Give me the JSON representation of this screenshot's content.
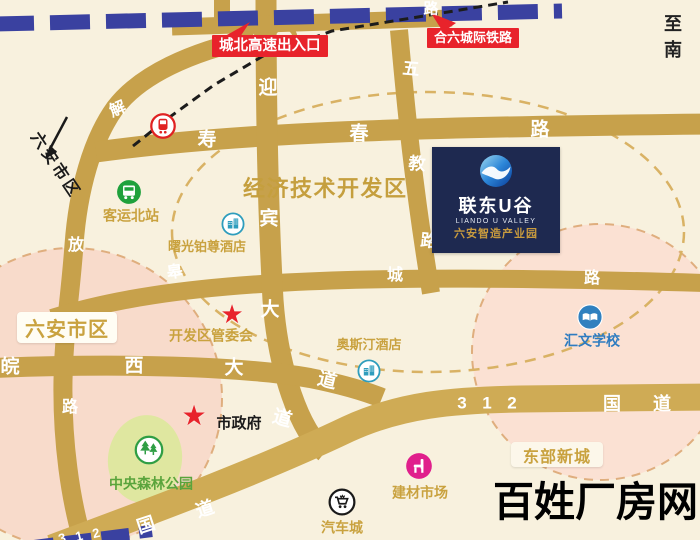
{
  "page": {
    "watermark": "百姓厂房网"
  },
  "map": {
    "zone_title": "经济技术开发区",
    "corner_note": "至南",
    "callouts": [
      {
        "name": "highway-exit-callout",
        "label": "城北高速出入口"
      },
      {
        "name": "intercity-railway-callout",
        "label": "合六城际铁路"
      }
    ],
    "landmark_card": {
      "name_cn": "联东U谷",
      "name_en": "LIANDO U VALLEY",
      "subtitle": "六安智造产业园",
      "logo_icon": "liando-swirl-icon"
    },
    "district_boxes": [
      {
        "name": "luan-downtown-box",
        "label": "六安市区"
      },
      {
        "name": "east-new-town-box",
        "label": "东部新城"
      }
    ],
    "direction_label": {
      "label": "六安市区"
    },
    "roads": [
      {
        "name": "jiefang-road",
        "label": "解放路",
        "chars": [
          {
            "t": "解",
            "x": 118,
            "y": 110,
            "s": 16,
            "r": -22
          },
          {
            "t": "放",
            "x": 76,
            "y": 246,
            "s": 16,
            "r": 0
          },
          {
            "t": "路",
            "x": 70,
            "y": 408,
            "s": 16,
            "r": 0
          }
        ]
      },
      {
        "name": "shouchun-road",
        "label": "寿春路",
        "chars": [
          {
            "t": "寿",
            "x": 207,
            "y": 140,
            "s": 19,
            "r": 0
          },
          {
            "t": "春",
            "x": 359,
            "y": 134,
            "s": 19,
            "r": 0
          },
          {
            "t": "路",
            "x": 540,
            "y": 130,
            "s": 19,
            "r": 0
          }
        ]
      },
      {
        "name": "north-ring-road",
        "label": "路",
        "chars": [
          {
            "t": "路",
            "x": 431,
            "y": 9,
            "s": 15,
            "r": 0
          }
        ]
      },
      {
        "name": "yingbin-avenue",
        "label": "迎宾大道",
        "chars": [
          {
            "t": "迎",
            "x": 268,
            "y": 88,
            "s": 19,
            "r": 0
          },
          {
            "t": "宾",
            "x": 269,
            "y": 219,
            "s": 19,
            "r": 0
          },
          {
            "t": "大",
            "x": 270,
            "y": 310,
            "s": 19,
            "r": 0
          },
          {
            "t": "道",
            "x": 282,
            "y": 419,
            "s": 19,
            "r": 16
          }
        ]
      },
      {
        "name": "wujiao-road",
        "label": "五教路",
        "chars": [
          {
            "t": "五",
            "x": 411,
            "y": 69,
            "s": 17,
            "r": 5
          },
          {
            "t": "教",
            "x": 417,
            "y": 164,
            "s": 17,
            "r": 5
          },
          {
            "t": "路",
            "x": 429,
            "y": 241,
            "s": 17,
            "r": 5
          }
        ]
      },
      {
        "name": "wanxi-avenue",
        "label": "皖西大道",
        "chars": [
          {
            "t": "皖",
            "x": 10,
            "y": 367,
            "s": 19,
            "r": 0
          },
          {
            "t": "西",
            "x": 134,
            "y": 366,
            "s": 19,
            "r": 0
          },
          {
            "t": "大",
            "x": 234,
            "y": 368,
            "s": 19,
            "r": 0
          },
          {
            "t": "道",
            "x": 327,
            "y": 381,
            "s": 19,
            "r": 14
          }
        ]
      },
      {
        "name": "gaocheng-road",
        "label": "皋城路",
        "chars": [
          {
            "t": "皋",
            "x": 175,
            "y": 273,
            "s": 16,
            "r": -8
          },
          {
            "t": "城",
            "x": 395,
            "y": 276,
            "s": 16,
            "r": 0
          },
          {
            "t": "路",
            "x": 592,
            "y": 279,
            "s": 16,
            "r": 0
          }
        ]
      },
      {
        "name": "g312-national-road",
        "label": "312国道",
        "chars": [
          {
            "t": "3",
            "x": 462,
            "y": 403,
            "s": 17,
            "r": 0
          },
          {
            "t": "1",
            "x": 487,
            "y": 403,
            "s": 17,
            "r": 0
          },
          {
            "t": "2",
            "x": 512,
            "y": 403,
            "s": 17,
            "r": 0
          },
          {
            "t": "国",
            "x": 612,
            "y": 404,
            "s": 18,
            "r": 0
          },
          {
            "t": "道",
            "x": 662,
            "y": 404,
            "s": 18,
            "r": 0
          },
          {
            "t": "国",
            "x": 146,
            "y": 525,
            "s": 18,
            "r": -18
          },
          {
            "t": "道",
            "x": 205,
            "y": 509,
            "s": 18,
            "r": -18
          },
          {
            "t": "3",
            "x": 62,
            "y": 538,
            "s": 13,
            "r": -14
          },
          {
            "t": "1",
            "x": 79,
            "y": 536,
            "s": 13,
            "r": -14
          },
          {
            "t": "2",
            "x": 96,
            "y": 533,
            "s": 13,
            "r": -14
          }
        ]
      }
    ],
    "pois": [
      {
        "name": "north-railway-crossing",
        "icon": "train-icon",
        "ix": 163,
        "iy": 126,
        "isize": 27
      },
      {
        "name": "north-bus-station",
        "icon": "bus-icon",
        "ix": 129,
        "iy": 192,
        "isize": 26,
        "label": "客运北站",
        "lx": 131,
        "ly": 216,
        "color": "#c9a23f",
        "lsize": 14
      },
      {
        "name": "shuguang-platinum-hotel",
        "icon": "hotel-icon",
        "ix": 233,
        "iy": 224,
        "isize": 24,
        "label": "曙光铂尊酒店",
        "lx": 207,
        "ly": 247,
        "color": "#c9a23f",
        "lsize": 13
      },
      {
        "name": "development-zone-committee",
        "icon": "star-icon",
        "ix": 232,
        "iy": 314,
        "isize": 26,
        "label": "开发区管委会",
        "lx": 211,
        "ly": 336,
        "color": "#c9a23f",
        "lsize": 14
      },
      {
        "name": "austin-hotel",
        "icon": "hotel-icon",
        "ix": 369,
        "iy": 371,
        "isize": 24,
        "label": "奥斯汀酒店",
        "lx": 369,
        "ly": 345,
        "color": "#c9a23f",
        "lsize": 13
      },
      {
        "name": "city-hall",
        "icon": "star-icon",
        "ix": 194,
        "iy": 416,
        "isize": 28,
        "label": "市政府",
        "lx": 239,
        "ly": 424,
        "color": "#1a1a1a",
        "lsize": 15
      },
      {
        "name": "central-forest-park",
        "icon": "park-icon",
        "ix": 149,
        "iy": 450,
        "isize": 30,
        "label": "中央森林公园",
        "lx": 151,
        "ly": 484,
        "color": "#5aa43c",
        "lsize": 14
      },
      {
        "name": "building-material-market",
        "icon": "market-icon",
        "ix": 419,
        "iy": 466,
        "isize": 28,
        "label": "建材市场",
        "lx": 420,
        "ly": 493,
        "color": "#c9a23f",
        "lsize": 14
      },
      {
        "name": "auto-city",
        "icon": "cart-icon",
        "ix": 342,
        "iy": 502,
        "isize": 28,
        "label": "汽车城",
        "lx": 342,
        "ly": 528,
        "color": "#c9a23f",
        "lsize": 14
      },
      {
        "name": "huiwen-school",
        "icon": "school-icon",
        "ix": 590,
        "iy": 317,
        "isize": 27,
        "label": "汇文学校",
        "lx": 592,
        "ly": 341,
        "color": "#2e7cc0",
        "lsize": 14
      }
    ],
    "colors": {
      "road_gold": "#c7a14b",
      "g312_gold": "#cfab55",
      "railway_navy": "#3a41a0",
      "callout_red": "#e8232b",
      "card_navy": "#1e2950",
      "gold_text": "#c9a23f",
      "circle_fill_pink": "#f8dbcb",
      "dashed_tan": "#d9b264"
    }
  }
}
